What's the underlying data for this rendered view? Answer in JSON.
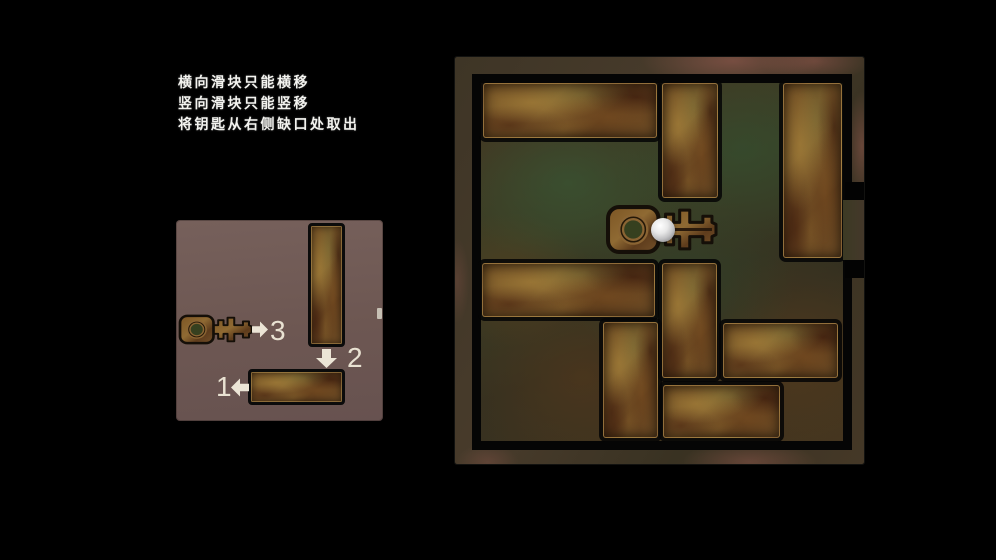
{
  "instructions": {
    "lines": [
      "横向滑块只能横移",
      "竖向滑块只能竖移",
      "将钥匙从右侧缺口处取出"
    ]
  },
  "solution_panel": {
    "panel_rect": {
      "x": 176,
      "y": 220,
      "w": 207,
      "h": 201
    },
    "steps": [
      {
        "label": "1",
        "direction": "left",
        "arrow_rect": {
          "x": 55,
          "y": 158,
          "w": 18,
          "h": 19
        },
        "label_rect": {
          "x": 40,
          "y": 153
        }
      },
      {
        "label": "2",
        "direction": "down",
        "arrow_rect": {
          "x": 140,
          "y": 129,
          "w": 21,
          "h": 19
        },
        "label_rect": {
          "x": 171,
          "y": 124
        }
      },
      {
        "label": "3",
        "direction": "right",
        "arrow_rect": {
          "x": 76,
          "y": 101,
          "w": 16,
          "h": 17
        },
        "label_rect": {
          "x": 94,
          "y": 97
        }
      }
    ],
    "vertical_block": {
      "x": 132,
      "y": 3,
      "w": 37,
      "h": 124
    },
    "horizontal_block": {
      "x": 72,
      "y": 149,
      "w": 97,
      "h": 36
    },
    "key_rect": {
      "x": 2,
      "y": 94,
      "w": 75,
      "h": 31
    },
    "exit_mark": {
      "x": 201,
      "y": 88,
      "w": 5,
      "h": 11
    }
  },
  "board": {
    "board_rect": {
      "x": 455,
      "y": 57,
      "w": 409,
      "h": 407
    },
    "play_rect": {
      "x": 17,
      "y": 17,
      "w": 380,
      "h": 376
    },
    "grid": {
      "cols": 6,
      "rows": 6,
      "cell_px": 60
    },
    "blocks": [
      {
        "id": "h3-top-left",
        "orient": "horizontal",
        "cells": {
          "col": 0,
          "row": 0,
          "w": 3,
          "h": 1
        },
        "px": {
          "x": 2,
          "y": 0,
          "w": 174,
          "h": 55
        }
      },
      {
        "id": "v2-top-mid",
        "orient": "vertical",
        "cells": {
          "col": 3,
          "row": 0,
          "w": 1,
          "h": 2
        },
        "px": {
          "x": 181,
          "y": 0,
          "w": 56,
          "h": 115
        }
      },
      {
        "id": "v3-right",
        "orient": "vertical",
        "cells": {
          "col": 5,
          "row": 0,
          "w": 1,
          "h": 3
        },
        "px": {
          "x": 302,
          "y": 0,
          "w": 59,
          "h": 175
        }
      },
      {
        "id": "h3-mid-left",
        "orient": "horizontal",
        "cells": {
          "col": 0,
          "row": 3,
          "w": 3,
          "h": 1
        },
        "px": {
          "x": 1,
          "y": 180,
          "w": 173,
          "h": 54
        }
      },
      {
        "id": "v2-mid",
        "orient": "vertical",
        "cells": {
          "col": 3,
          "row": 3,
          "w": 1,
          "h": 2
        },
        "px": {
          "x": 181,
          "y": 180,
          "w": 55,
          "h": 115
        }
      },
      {
        "id": "h2-right",
        "orient": "horizontal",
        "cells": {
          "col": 4,
          "row": 4,
          "w": 2,
          "h": 1
        },
        "px": {
          "x": 242,
          "y": 240,
          "w": 115,
          "h": 55
        }
      },
      {
        "id": "v2-bottom",
        "orient": "vertical",
        "cells": {
          "col": 2,
          "row": 4,
          "w": 1,
          "h": 2
        },
        "px": {
          "x": 122,
          "y": 239,
          "w": 55,
          "h": 116
        }
      },
      {
        "id": "h2-bottom",
        "orient": "horizontal",
        "cells": {
          "col": 3,
          "row": 5,
          "w": 2,
          "h": 1
        },
        "px": {
          "x": 182,
          "y": 302,
          "w": 117,
          "h": 53
        }
      }
    ],
    "key": {
      "px": {
        "x": 124,
        "y": 121,
        "w": 113,
        "h": 51
      },
      "cells": {
        "col": 2,
        "row": 2,
        "w": 2,
        "h": 1
      }
    },
    "ball": {
      "px": {
        "x": 170,
        "y": 135,
        "w": 24,
        "h": 24
      }
    },
    "exit": {
      "side": "right",
      "row": 2,
      "channel": {
        "x": 388,
        "y": 143,
        "w": 21,
        "h": 60
      },
      "tab_top": {
        "x": 390,
        "y": 125,
        "w": 19,
        "h": 18
      },
      "tab_bottom": {
        "x": 390,
        "y": 203,
        "w": 19,
        "h": 18
      }
    }
  },
  "colors": {
    "background": "#000000",
    "panel_bg": "#6e5955",
    "frame_base": "#443827",
    "frame_pink": "#8a5c55",
    "floor_green": "#3a4a2e",
    "floor_brown": "#4a3420",
    "block_rust": "#7a5a28",
    "arrow_cream": "#ece5d6",
    "text_white": "#f3f3ef",
    "ball_white": "#e8e8e8"
  }
}
